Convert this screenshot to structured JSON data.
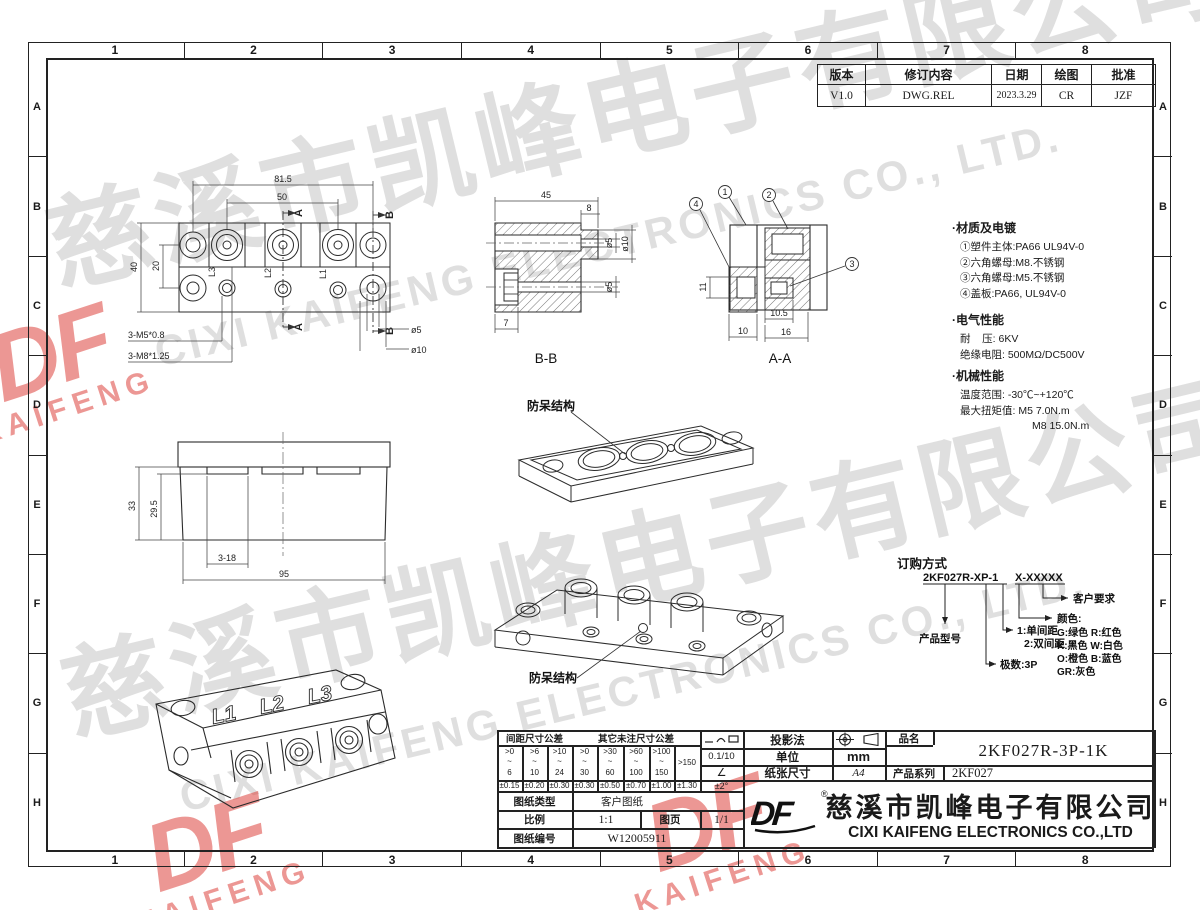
{
  "frame": {
    "cols": [
      "1",
      "2",
      "3",
      "4",
      "5",
      "6",
      "7",
      "8"
    ],
    "rows": [
      "A",
      "B",
      "C",
      "D",
      "E",
      "F",
      "G",
      "H"
    ]
  },
  "revision": {
    "h_version": "版本",
    "h_content": "修订内容",
    "h_date": "日期",
    "h_draw": "绘图",
    "h_approve": "批准",
    "version": "V1.0",
    "content": "DWG.REL",
    "date": "2023.3.29",
    "draw": "CR",
    "approve": "JZF"
  },
  "notes": {
    "material_title": "·材质及电镀",
    "material": [
      "①塑件主体:PA66 UL94V-0",
      "②六角螺母:M8.不锈钢",
      "③六角螺母:M5.不锈钢",
      "④盖板:PA66, UL94V-0"
    ],
    "electrical_title": "·电气性能",
    "electrical": [
      "耐    压: 6KV",
      "绝缘电阻: 500MΩ/DC500V"
    ],
    "mechanical_title": "·机械性能",
    "mechanical": [
      "温度范围: -30℃~+120℃",
      "最大扭矩值: M5 7.0N.m",
      "M8 15.0N.m"
    ]
  },
  "ordering": {
    "title": "订购方式",
    "code_a": "2KF027R-XP-1",
    "code_b": "X-XXXXX",
    "customer": "客户要求",
    "color_title": "颜色:",
    "colors": [
      "G:绿色  R:红色",
      "K:黑色  W:白色",
      "O:橙色  B:蓝色",
      "GR:灰色"
    ],
    "pitch1": "1:单间距",
    "pitch2": "2:双间距",
    "poles": "极数:3P",
    "model": "产品型号"
  },
  "views": {
    "front": {
      "d815": "81.5",
      "d50": "50",
      "d40": "40",
      "d20": "20",
      "a": "A",
      "b": "B",
      "m5": "3-M5*0.8",
      "m8": "3-M8*1.25",
      "d5": "ø5",
      "d10": "ø10",
      "l1": "L1",
      "l2": "L2",
      "l3": "L3"
    },
    "bb": {
      "d45": "45",
      "d8": "8",
      "d5": "ø5",
      "d10": "ø10",
      "d5b": "ø5",
      "d7": "7",
      "label": "B-B"
    },
    "aa": {
      "d11": "11",
      "d105": "10.5",
      "d10": "10",
      "d16": "16",
      "label": "A-A",
      "b1": "1",
      "b2": "2",
      "b3": "3",
      "b4": "4"
    },
    "cover": {
      "label": "防呆结构"
    },
    "side": {
      "d33": "33",
      "d295": "29.5",
      "d318": "3-18",
      "d95": "95"
    },
    "body": {
      "label": "防呆结构"
    },
    "iso": {
      "l1": "L1",
      "l2": "L2",
      "l3": "L3"
    }
  },
  "tolerance": {
    "header_pitch": "间距尺寸公差",
    "header_other": "其它未注尺寸公差",
    "r_top": [
      ">0",
      ">6",
      ">10",
      ">0",
      ">30",
      ">60",
      ">100"
    ],
    "r_mid": "~",
    "r_last": ">150",
    "r_bot": [
      "6",
      "10",
      "24",
      "30",
      "60",
      "100",
      "150"
    ],
    "tols": [
      "±0.15",
      "±0.20",
      "±0.30",
      "±0.30",
      "±0.50",
      "±0.70",
      "±1.00",
      "±1.30"
    ]
  },
  "block": {
    "flatness": "0.1/10",
    "angle_sym": "∠",
    "angle_tol": "±2°",
    "projection": "投影法",
    "unit": "单位",
    "unit_val": "mm",
    "paper": "纸张尺寸",
    "paper_val": "A4",
    "name_label": "品名",
    "name_val": "2KF027R-3P-1K",
    "series_label": "产品系列",
    "series_val": "2KF027",
    "type_label": "图纸类型",
    "type_val": "客户图纸",
    "scale_label": "比例",
    "scale_val": "1:1",
    "sheet_label": "图页",
    "sheet_val": "1/1",
    "no_label": "图纸编号",
    "no_val": "W12005911",
    "company_cn": "慈溪市凯峰电子有限公司",
    "company_en": "CIXI KAIFENG ELECTRONICS CO.,LTD",
    "logo": "DF",
    "reg": "®"
  },
  "watermark": {
    "cn": "慈溪市凯峰电子有限公司",
    "en": "CIXI KAIFENG ELECTRONICS CO., LTD.",
    "logo_main": "DF",
    "logo_sub": "KAIFENG"
  }
}
